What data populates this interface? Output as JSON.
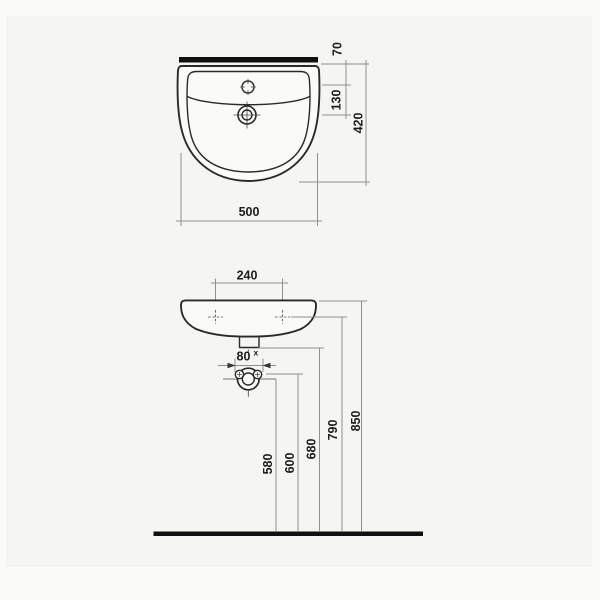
{
  "colors": {
    "page": "#fbfbf9",
    "canvas": "#f5f5f2",
    "outline": "#2a2a2a",
    "dim": "#8f8f8f",
    "ink": "#101010",
    "text": "#1c1c1c",
    "fill": "#fafaf8"
  },
  "top_view": {
    "rim_to_faucet": "70",
    "faucet_to_drain": "130",
    "overall_depth": "420",
    "overall_width": "500"
  },
  "front_view": {
    "hole_spacing": "240",
    "fixing_spacing": "80",
    "fixing_spacing_sup": "x",
    "heights": [
      "580",
      "600",
      "680",
      "790",
      "850"
    ]
  }
}
